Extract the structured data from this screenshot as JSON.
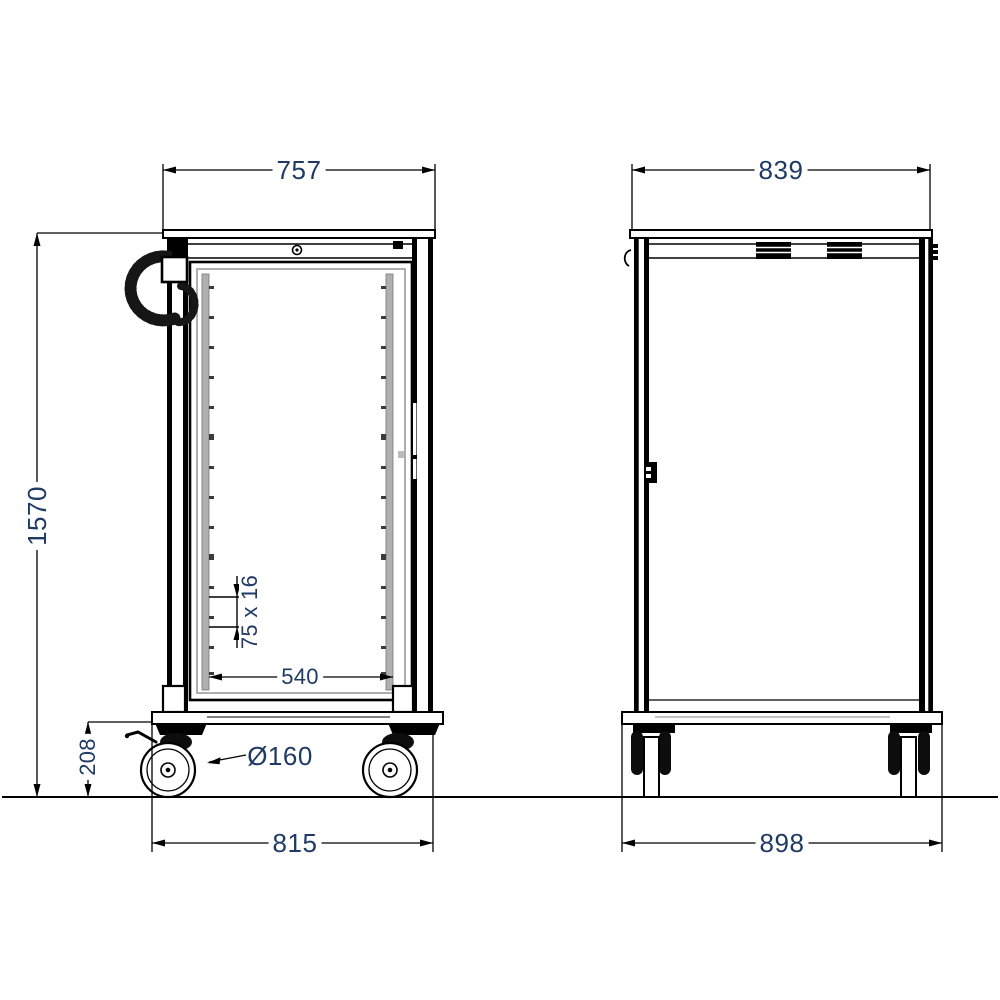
{
  "drawing": {
    "type": "technical-dimension-drawing",
    "subject": "meal-delivery-trolley-two-views",
    "views": {
      "front_view": "glass-door-cabinet-on-casters",
      "side_view": "closed-panel-cabinet-on-casters"
    },
    "dimensions": {
      "front_width_top": "757",
      "side_depth_top": "839",
      "overall_height": "1570",
      "base_height": "208",
      "front_width_base": "815",
      "side_depth_base": "898",
      "interior_width": "540",
      "rail_detail": "75 x 16",
      "caster_diameter": "Ø160"
    },
    "colors": {
      "dimension_text": "#203a66",
      "line": "#000000",
      "rail_gray": "#b0b0b0"
    }
  }
}
